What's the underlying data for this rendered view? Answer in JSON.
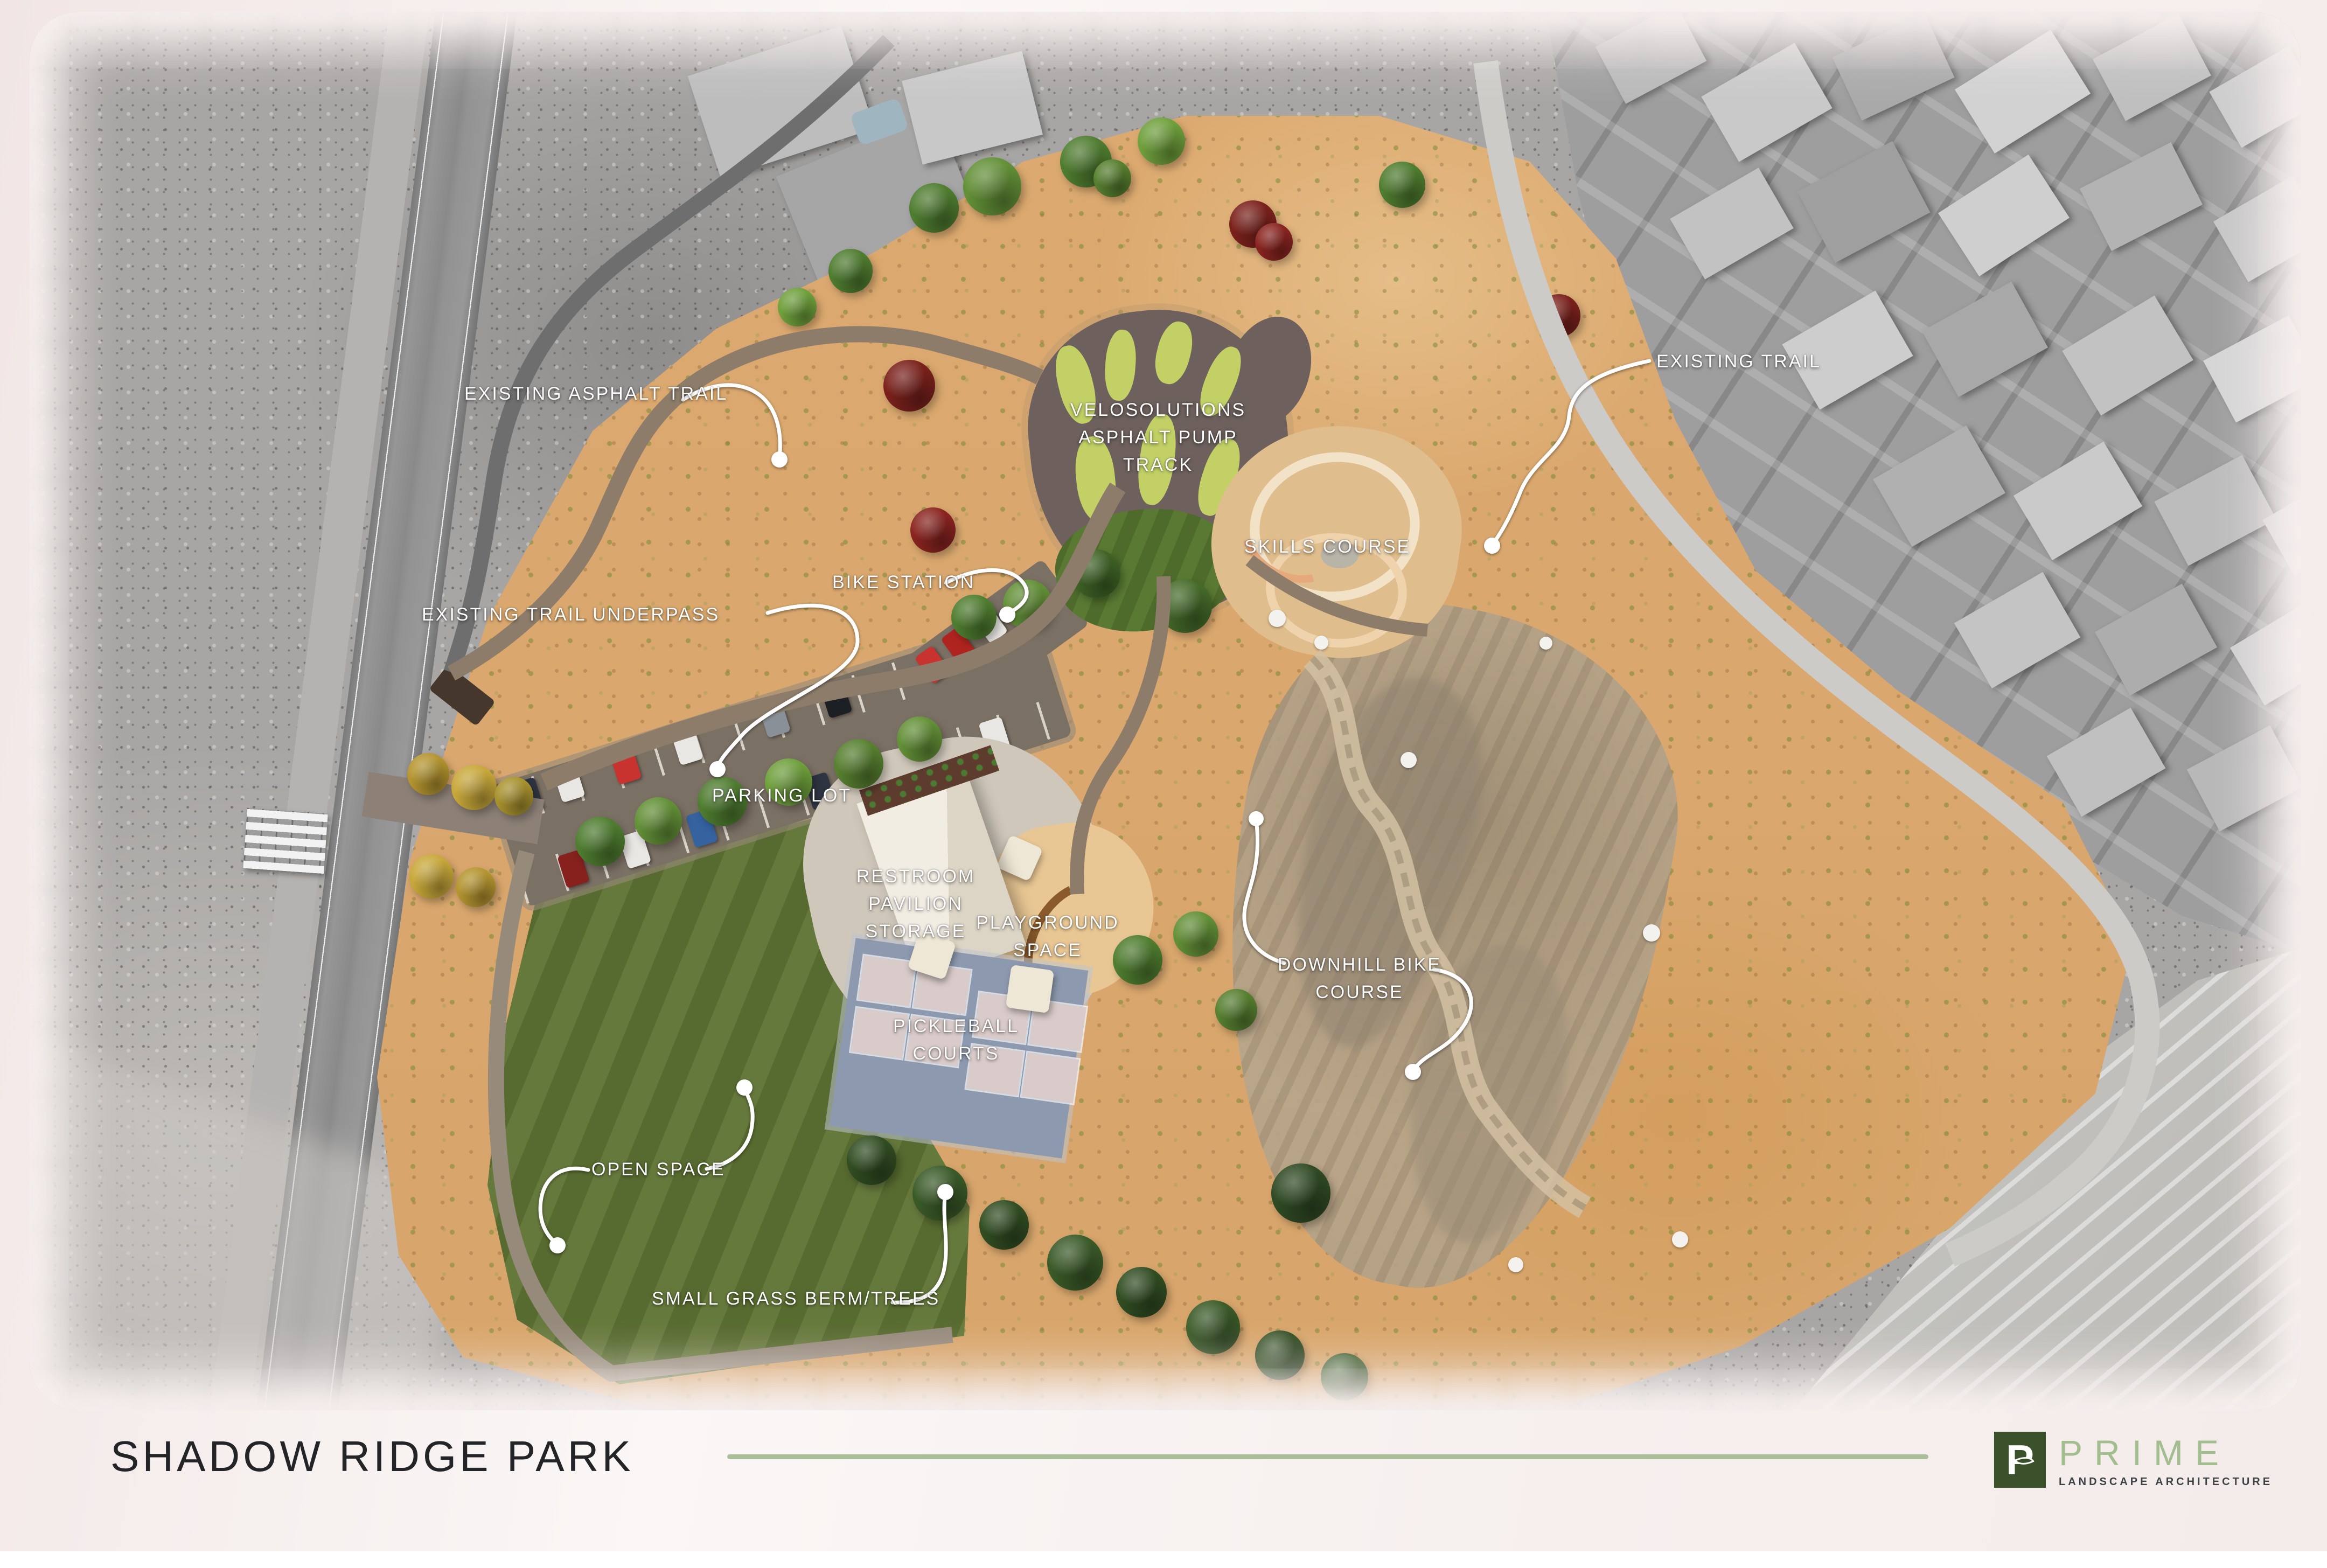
{
  "footer": {
    "title": "SHADOW RIDGE PARK"
  },
  "brand": {
    "mark": "P",
    "name": "PRIME",
    "tagline": "LANDSCAPE ARCHITECTURE"
  },
  "map": {
    "labels": {
      "existing_asphalt_trail": "EXISTING ASPHALT TRAIL",
      "existing_trail": "EXISTING TRAIL",
      "existing_trail_underpass": "EXISTING TRAIL UNDERPASS",
      "bike_station": "BIKE STATION",
      "velosolutions": "VELOSOLUTIONS\nASPHALT PUMP\nTRACK",
      "skills_course": "SKILLS COURSE",
      "parking_lot": "PARKING LOT",
      "restroom": "RESTROOM\nPAVILION\nSTORAGE",
      "playground": "PLAYGROUND\nSPACE",
      "pickleball": "PICKLEBALL\nCOURTS",
      "downhill": "DOWNHILL BIKE\nCOURSE",
      "open_space": "OPEN SPACE",
      "small_grass_berm": "SMALL GRASS BERM/TREES"
    }
  },
  "colors": {
    "accent_sage": "#a9bf97",
    "logo_green": "#3a512c",
    "park_sand": "#dcaa70",
    "lawn_green": "#66793c",
    "court_deck_blue": "#8d99af",
    "pump_track_island": "#c2d066",
    "label_white": "#ffffff"
  }
}
